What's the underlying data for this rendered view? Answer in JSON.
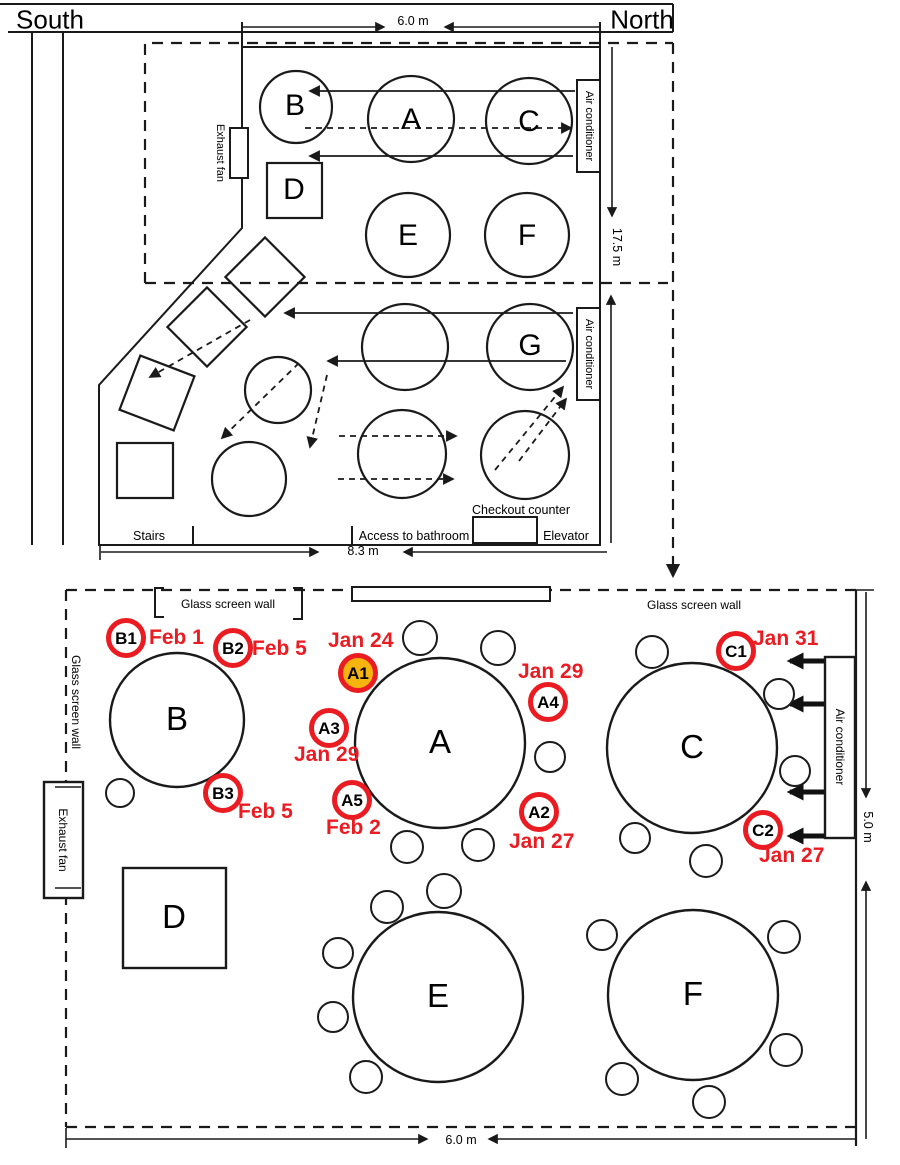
{
  "orientation": {
    "south": "South",
    "north": "North"
  },
  "colors": {
    "case_ring_red": "#ea1c22",
    "index_case_yellow": "#f6b40e",
    "line": "#1a1a1a"
  },
  "upper_plan": {
    "dim_width_top": "6.0 m",
    "dim_height_right": "17.5 m",
    "dim_width_bottom": "8.3 m",
    "exhaust_fan": "Exhaust fan",
    "air_conditioner": "Air conditioner",
    "stairs": "Stairs",
    "access_to_bathroom": "Access to bathroom",
    "checkout_counter": "Checkout counter",
    "elevator": "Elevator",
    "tables": {
      "a": "A",
      "b": "B",
      "c": "C",
      "d": "D",
      "e": "E",
      "f": "F",
      "g": "G"
    }
  },
  "lower_plan": {
    "dim_height_right": "5.0 m",
    "dim_width_bottom": "6.0 m",
    "glass_screen_wall": "Glass screen wall",
    "exhaust_fan": "Exhaust fan",
    "air_conditioner": "Air conditioner",
    "tables": {
      "a": "A",
      "b": "B",
      "c": "C",
      "d": "D",
      "e": "E",
      "f": "F"
    },
    "seats": [
      {
        "id": "B1",
        "date": "Feb 1"
      },
      {
        "id": "B2",
        "date": "Feb 5"
      },
      {
        "id": "B3",
        "date": "Feb 5"
      },
      {
        "id": "A1",
        "date": "Jan 24",
        "highlighted": true
      },
      {
        "id": "A3",
        "date": "Jan 29"
      },
      {
        "id": "A5",
        "date": "Feb 2"
      },
      {
        "id": "A4",
        "date": "Jan 29"
      },
      {
        "id": "A2",
        "date": "Jan 27"
      },
      {
        "id": "C1",
        "date": "Jan 31"
      },
      {
        "id": "C2",
        "date": "Jan 27"
      }
    ]
  }
}
